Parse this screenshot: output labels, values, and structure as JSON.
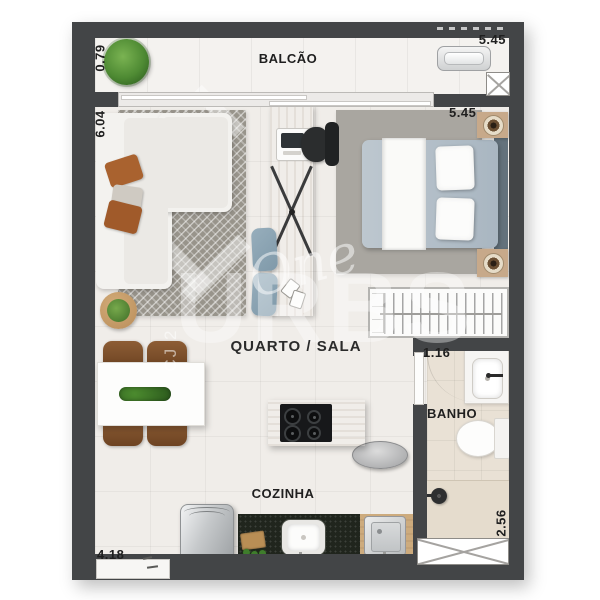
{
  "rooms": {
    "balcony": "BALCÃO",
    "bedroom_living": "QUARTO / SALA",
    "bathroom": "BANHO",
    "kitchen": "COZINHA"
  },
  "dims": {
    "balcony_depth": "0.79",
    "balcony_width": "5.45",
    "living_length": "6.04",
    "bedroom_width": "5.45",
    "bathroom_width": "1.16",
    "bathroom_length": "2.56",
    "kitchen_width": "4.18"
  },
  "watermark": {
    "script": "One",
    "brand": "URBS",
    "vertical": "CJ 2"
  },
  "colors": {
    "wall": "#434547",
    "main_floor": "#f0ede9",
    "balcony_floor": "#f4f2ef",
    "bathroom_floor": "#e9e1d5",
    "wood": "#c9aa80",
    "granite_counter": "#20251d",
    "duvet_blue": "#b7c2cb",
    "living_rug": "#98948b",
    "bedroom_rug": "#a9a6a0",
    "pillow_brown": "#a9622f",
    "stool_blue": "#8da6b5"
  }
}
